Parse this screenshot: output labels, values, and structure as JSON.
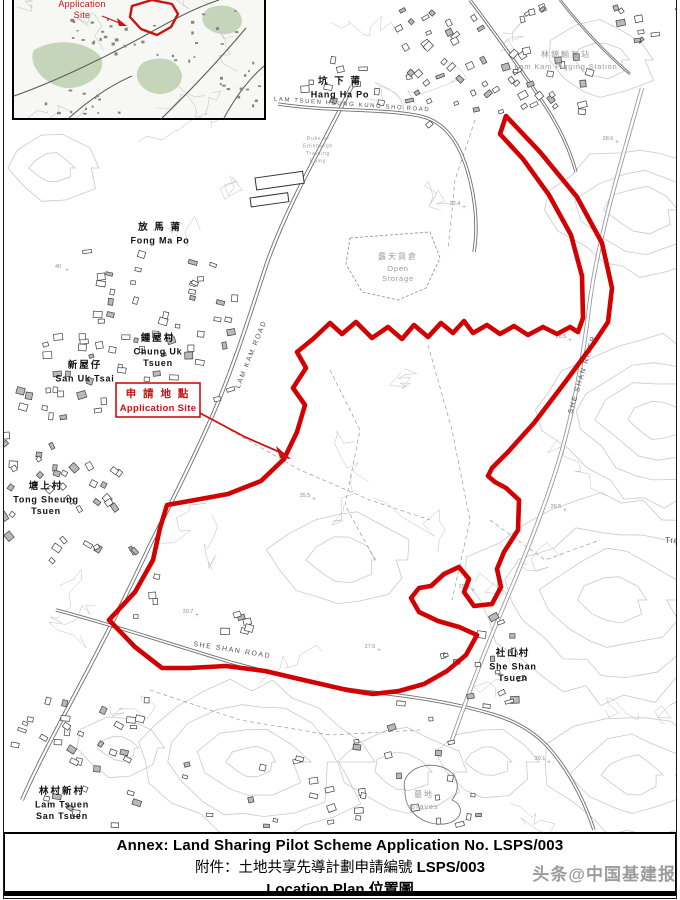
{
  "colors": {
    "boundary_red": "#d20000",
    "callout_red": "#cc1111",
    "contour_gray": "#c9c9c9",
    "road_gray": "#6e6e6e",
    "label_black": "#111111",
    "label_gray": "#8f8f8f",
    "watermark_gray": "#8b8b8b"
  },
  "title_block": {
    "line1": "Annex: Land Sharing Pilot Scheme Application No. LSPS/003",
    "line2_prefix": "附件：土地共享先導計劃申請編號 ",
    "line2_code": "LSPS/003",
    "line3_en": "Location Plan",
    "line3_zh": " 位置圖"
  },
  "watermark": "头条@中国基建报",
  "inset": {
    "label_line1": "Application",
    "label_line2": "Site"
  },
  "callout": {
    "zh": "申 請 地 點",
    "en": "Application Site"
  },
  "map_labels": [
    {
      "name": "hang-ha-po",
      "zh": "坑 下 莆",
      "en": [
        "Hang Ha Po"
      ],
      "x": 340,
      "y": 84,
      "color": "#111111",
      "size": 9.5,
      "bold": true
    },
    {
      "name": "lam-kam-pigging-station",
      "zh": "林錦輸氣站",
      "en": [
        "Lam Kam Pigging Station"
      ],
      "x": 566,
      "y": 57,
      "color": "#9a9a9a",
      "size": 8,
      "bold": false
    },
    {
      "name": "fong-ma-po",
      "zh": "放 馬 莆",
      "en": [
        "Fong Ma Po"
      ],
      "x": 160,
      "y": 230,
      "color": "#111111",
      "size": 9.5,
      "bold": true
    },
    {
      "name": "open-storage",
      "zh": "露天貨倉",
      "en": [
        "Open",
        "Storage"
      ],
      "x": 398,
      "y": 259,
      "color": "#9a9a9a",
      "size": 8,
      "bold": false
    },
    {
      "name": "chung-uk-tsuen",
      "zh": "鍾屋村",
      "en": [
        "Chung Uk",
        "Tsuen"
      ],
      "x": 158,
      "y": 341,
      "color": "#111111",
      "size": 9.5,
      "bold": true
    },
    {
      "name": "san-uk-tsai",
      "zh": "新屋仔",
      "en": [
        "San Uk Tsai"
      ],
      "x": 85,
      "y": 368,
      "color": "#111111",
      "size": 9.5,
      "bold": true
    },
    {
      "name": "tong-sheung-tsuen",
      "zh": "塘上村",
      "en": [
        "Tong Sheung",
        "Tsuen"
      ],
      "x": 46,
      "y": 489,
      "color": "#111111",
      "size": 9.5,
      "bold": true
    },
    {
      "name": "she-shan-tsuen",
      "zh": "社山村",
      "en": [
        "She Shan",
        "Tsuen"
      ],
      "x": 513,
      "y": 656,
      "color": "#111111",
      "size": 9.5,
      "bold": true
    },
    {
      "name": "lam-tsuen-san-tsuen",
      "zh": "林村新村",
      "en": [
        "Lam Tsuen",
        "San Tsuen"
      ],
      "x": 62,
      "y": 794,
      "color": "#111111",
      "size": 9.5,
      "bold": true
    },
    {
      "name": "graves",
      "zh": "墓地",
      "en": [
        "Graves"
      ],
      "x": 424,
      "y": 797,
      "color": "#9a9a9a",
      "size": 8,
      "bold": false
    },
    {
      "name": "tre-cutoff",
      "zh": "",
      "en": [
        "Tre"
      ],
      "x": 672,
      "y": 543,
      "color": "#555555",
      "size": 8.5,
      "bold": false
    },
    {
      "name": "training-camp",
      "zh": "",
      "en": [
        "Duke of",
        "Edinburgh",
        "Training",
        "Camp"
      ],
      "x": 318,
      "y": 140,
      "color": "#9a9a9a",
      "size": 5.5,
      "bold": false
    }
  ],
  "road_labels": [
    {
      "name": "lam-kam-road",
      "text": "LAM KAM ROAD",
      "x": 253,
      "y": 355,
      "rot": -68,
      "size": 7
    },
    {
      "name": "she-shan-road",
      "text": "SHE SHAN ROAD",
      "x": 232,
      "y": 652,
      "rot": 9,
      "size": 7
    },
    {
      "name": "she-shan-river",
      "text": "SHE SHAN RIVER",
      "x": 584,
      "y": 375,
      "rot": -73,
      "size": 7
    },
    {
      "name": "lam-tsuen-heung-kung-sho-road",
      "text": "LAM TSUEN HEUNG KUNG SHO ROAD",
      "x": 352,
      "y": 106,
      "rot": 4,
      "size": 6
    }
  ],
  "spot_heights": [
    {
      "t": "28.6",
      "x": 608,
      "y": 140
    },
    {
      "t": "28.5",
      "x": 561,
      "y": 338
    },
    {
      "t": "22.4",
      "x": 455,
      "y": 205
    },
    {
      "t": "35.5",
      "x": 305,
      "y": 497
    },
    {
      "t": "26.5",
      "x": 556,
      "y": 508
    },
    {
      "t": "27.6",
      "x": 370,
      "y": 648
    },
    {
      "t": "25.3",
      "x": 464,
      "y": 588
    },
    {
      "t": "30.1",
      "x": 540,
      "y": 760
    },
    {
      "t": "40",
      "x": 58,
      "y": 268
    },
    {
      "t": "30.7",
      "x": 188,
      "y": 613
    }
  ]
}
